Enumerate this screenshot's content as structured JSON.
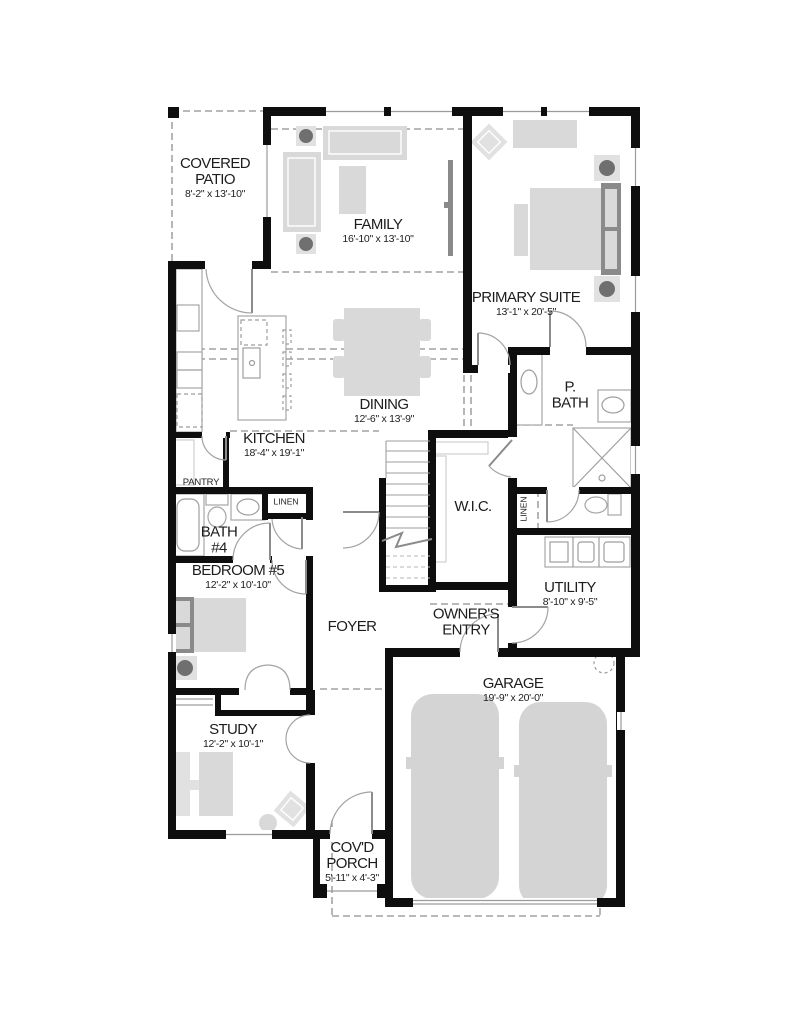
{
  "plan": {
    "type": "single-family-home-first-floor-plan",
    "colors": {
      "wall": "#0e0e0e",
      "furniture": "#d9d9d9",
      "furniture_dark": "#6f6f6f",
      "line_gray": "#9b9b9b",
      "background": "#ffffff"
    },
    "rooms": {
      "covered_patio": {
        "name": "COVERED PATIO",
        "dims": "8'-2\" x 13'-10\""
      },
      "family": {
        "name": "FAMILY",
        "dims": "16'-10\" x 13'-10\""
      },
      "primary_suite": {
        "name": "PRIMARY SUITE",
        "dims": "13'-1\" x 20'-5\""
      },
      "kitchen": {
        "name": "KITCHEN",
        "dims": "18'-4\" x 19'-1\""
      },
      "dining": {
        "name": "DINING",
        "dims": "12'-6\" x 13'-9\""
      },
      "pantry": {
        "name": "PANTRY"
      },
      "p_bath": {
        "name": "P. BATH"
      },
      "wic": {
        "name": "W.I.C."
      },
      "linen_hall": {
        "name": "LINEN"
      },
      "linen_suite": {
        "name": "LINEN"
      },
      "bath_4": {
        "name": "BATH #4"
      },
      "bedroom_5": {
        "name": "BEDROOM #5",
        "dims": "12'-2\" x 10'-10\""
      },
      "foyer": {
        "name": "FOYER"
      },
      "owners_entry": {
        "name": "OWNER'S ENTRY"
      },
      "utility": {
        "name": "UTILITY",
        "dims": "8'-10\" x 9'-5\""
      },
      "garage": {
        "name": "GARAGE",
        "dims": "19'-9\" x 20'-0\""
      },
      "study": {
        "name": "STUDY",
        "dims": "12'-2\" x 10'-1\""
      },
      "covd_porch": {
        "name": "COV'D PORCH",
        "dims": "5'-11\" x 4'-3\""
      }
    }
  }
}
